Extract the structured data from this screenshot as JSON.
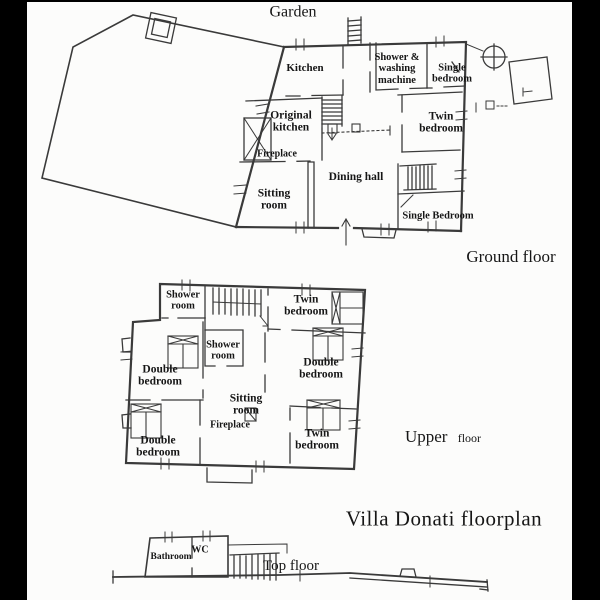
{
  "title": "Villa Donati floorplan",
  "colors": {
    "ink": "#3a3a3a",
    "paper": "#fcfcfb",
    "border": "#000000"
  },
  "garden": {
    "label": "Garden"
  },
  "ground_floor": {
    "label": "Ground floor",
    "rooms": {
      "kitchen": "Kitchen",
      "shower_washing_machine": "Shower & washing machine",
      "single_bedroom_top": "Single bedroom",
      "original_kitchen": "Original kitchen",
      "fireplace": "Fireplace",
      "twin_bedroom": "Twin bedroom",
      "dining_hall": "Dining hall",
      "sitting_room": "Sitting room",
      "single_bedroom_bottom": "Single Bedroom"
    }
  },
  "upper_floor": {
    "label_main": "Upper",
    "label_sub": "floor",
    "rooms": {
      "shower_room_top": "Shower room",
      "twin_bedroom_top": "Twin bedroom",
      "shower_room_middle": "Shower room",
      "double_bedroom_left": "Double bedroom",
      "double_bedroom_right": "Double bedroom",
      "sitting_room": "Sitting room",
      "fireplace": "Fireplace",
      "double_bedroom_bottom": "Double bedroom",
      "twin_bedroom_bottom": "Twin bedroom"
    }
  },
  "top_floor": {
    "label": "Top floor",
    "rooms": {
      "bathroom": "Bathroom",
      "wc": "WC"
    }
  }
}
